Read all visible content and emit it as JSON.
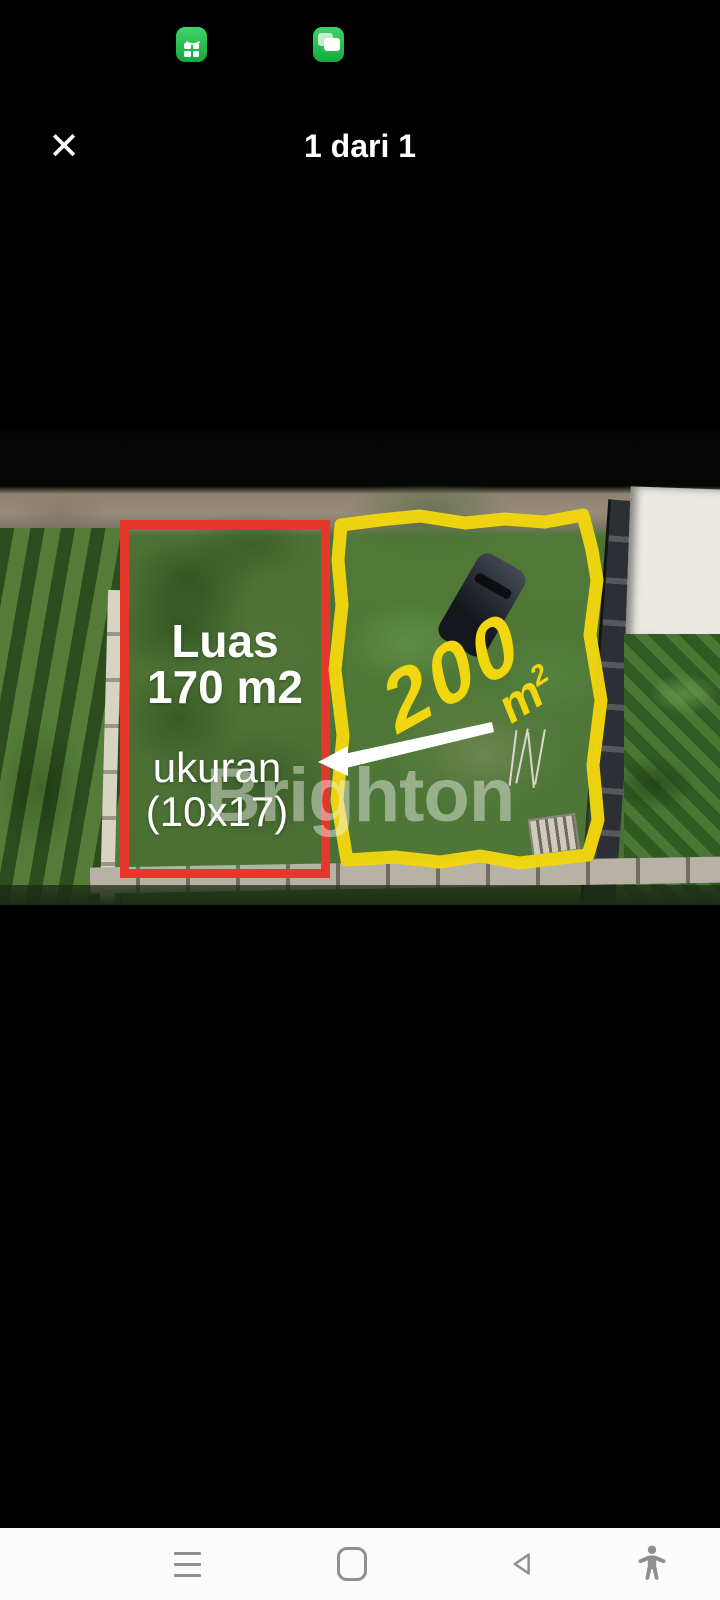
{
  "status_bar": {
    "icons": [
      {
        "name": "shop-grid-notification-icon",
        "color": "#2fc857"
      },
      {
        "name": "messages-notification-icon",
        "color": "#2fc857"
      }
    ]
  },
  "header": {
    "close_glyph": "✕",
    "title": "1 dari 1"
  },
  "photo": {
    "watermark": "Brighton",
    "red_plot": {
      "outline_color": "#e5372c",
      "title": "Luas",
      "area": "170 m2",
      "size_label": "ukuran",
      "size_value": "(10x17)"
    },
    "yellow_plot": {
      "outline_color": "#f2d60e",
      "area_value": "200",
      "unit_base": "m",
      "unit_sup": "2"
    }
  },
  "nav_bar": {
    "items": [
      "menu",
      "home",
      "back",
      "accessibility"
    ]
  }
}
